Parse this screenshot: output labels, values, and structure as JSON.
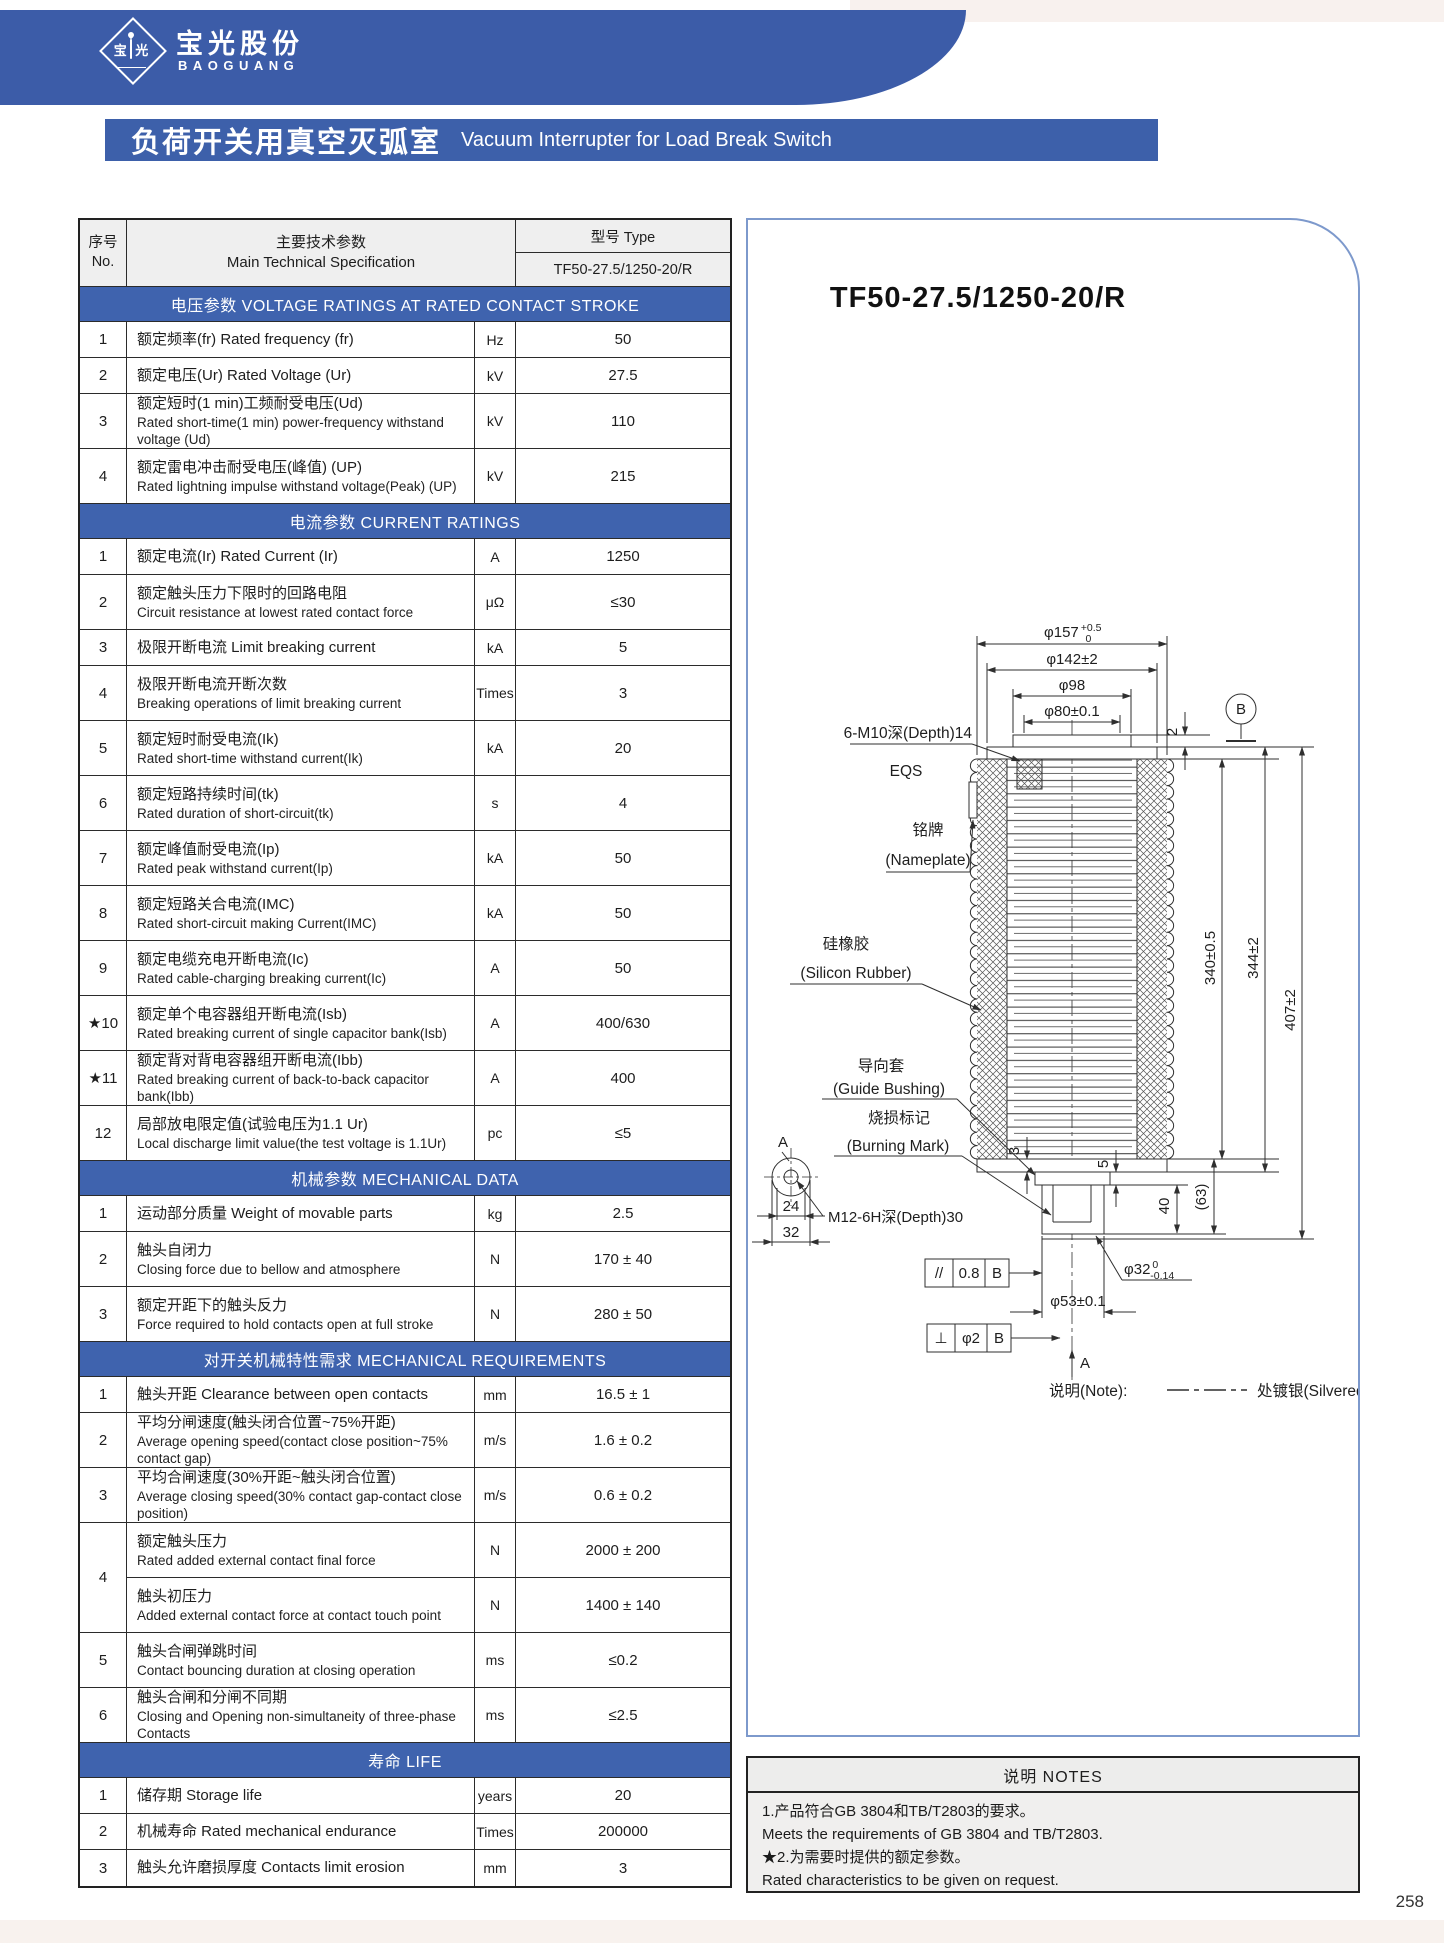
{
  "brand": {
    "logo_left": "宝",
    "logo_right": "光",
    "name_zh": "宝光股份",
    "name_en": "BAOGUANG"
  },
  "page": {
    "title_zh": "负荷开关用真空灭弧室",
    "title_en": "Vacuum Interrupter for Load Break Switch",
    "page_number": "258"
  },
  "table": {
    "header": {
      "no_zh": "序号",
      "no_en": "No.",
      "spec_zh": "主要技术参数",
      "spec_en": "Main Technical Specification",
      "type_label": "型号  Type",
      "type_value": "TF50-27.5/1250-20/R"
    },
    "sections": [
      {
        "title": "电压参数  VOLTAGE RATINGS AT RATED CONTACT STROKE",
        "rows": [
          {
            "no": "1",
            "zh": "额定频率(fr) Rated frequency (fr)",
            "unit": "Hz",
            "value": "50"
          },
          {
            "no": "2",
            "zh": "额定电压(Ur) Rated Voltage (Ur)",
            "unit": "kV",
            "value": "27.5"
          },
          {
            "no": "3",
            "zh": "额定短时(1 min)工频耐受电压(Ud)",
            "en": "Rated short-time(1 min) power-frequency withstand voltage (Ud)",
            "unit": "kV",
            "value": "110"
          },
          {
            "no": "4",
            "zh": "额定雷电冲击耐受电压(峰值) (UP)",
            "en": "Rated lightning impulse withstand voltage(Peak) (UP)",
            "unit": "kV",
            "value": "215"
          }
        ]
      },
      {
        "title": "电流参数  CURRENT RATINGS",
        "rows": [
          {
            "no": "1",
            "zh": "额定电流(Ir) Rated Current (Ir)",
            "unit": "A",
            "value": "1250"
          },
          {
            "no": "2",
            "zh": "额定触头压力下限时的回路电阻",
            "en": "Circuit resistance at lowest rated contact force",
            "unit": "μΩ",
            "value": "≤30"
          },
          {
            "no": "3",
            "zh": "极限开断电流 Limit breaking current",
            "unit": "kA",
            "value": "5"
          },
          {
            "no": "4",
            "zh": "极限开断电流开断次数",
            "en": "Breaking operations of limit breaking current",
            "unit": "Times",
            "value": "3"
          },
          {
            "no": "5",
            "zh": "额定短时耐受电流(Ik)",
            "en": "Rated short-time withstand current(Ik)",
            "unit": "kA",
            "value": "20"
          },
          {
            "no": "6",
            "zh": "额定短路持续时间(tk)",
            "en": "Rated duration of short-circuit(tk)",
            "unit": "s",
            "value": "4"
          },
          {
            "no": "7",
            "zh": "额定峰值耐受电流(Ip)",
            "en": "Rated peak withstand current(Ip)",
            "unit": "kA",
            "value": "50"
          },
          {
            "no": "8",
            "zh": "额定短路关合电流(IMC)",
            "en": "Rated short-circuit making Current(IMC)",
            "unit": "kA",
            "value": "50"
          },
          {
            "no": "9",
            "zh": "额定电缆充电开断电流(Ic)",
            "en": "Rated cable-charging breaking current(Ic)",
            "unit": "A",
            "value": "50"
          },
          {
            "no": "★10",
            "zh": "额定单个电容器组开断电流(Isb)",
            "en": "Rated breaking current of single capacitor bank(Isb)",
            "unit": "A",
            "value": "400/630"
          },
          {
            "no": "★11",
            "zh": "额定背对背电容器组开断电流(Ibb)",
            "en": "Rated breaking current of back-to-back capacitor bank(Ibb)",
            "unit": "A",
            "value": "400"
          },
          {
            "no": "12",
            "zh": "局部放电限定值(试验电压为1.1 Ur)",
            "en": "Local discharge limit value(the test voltage is 1.1Ur)",
            "unit": "pc",
            "value": "≤5"
          }
        ]
      },
      {
        "title": "机械参数  MECHANICAL DATA",
        "rows": [
          {
            "no": "1",
            "zh": "运动部分质量  Weight of movable parts",
            "unit": "kg",
            "value": "2.5"
          },
          {
            "no": "2",
            "zh": "触头自闭力",
            "en": "Closing force due to bellow and atmosphere",
            "unit": "N",
            "value": "170 ± 40"
          },
          {
            "no": "3",
            "zh": "额定开距下的触头反力",
            "en": "Force required to hold contacts open at full stroke",
            "unit": "N",
            "value": "280 ± 50"
          }
        ]
      },
      {
        "title": "对开关机械特性需求  MECHANICAL REQUIREMENTS",
        "rows": [
          {
            "no": "1",
            "zh": "触头开距 Clearance between open contacts",
            "unit": "mm",
            "value": "16.5 ± 1"
          },
          {
            "no": "2",
            "zh": "平均分闸速度(触头闭合位置~75%开距)",
            "en": "Average opening speed(contact close position~75% contact gap)",
            "unit": "m/s",
            "value": "1.6 ± 0.2"
          },
          {
            "no": "3",
            "zh": "平均合闸速度(30%开距~触头闭合位置)",
            "en": "Average closing speed(30% contact gap-contact close position)",
            "unit": "m/s",
            "value": "0.6 ± 0.2"
          },
          {
            "no": "4",
            "sub": [
              {
                "zh": "额定触头压力",
                "en": "Rated added external contact final force",
                "unit": "N",
                "value": "2000 ± 200"
              },
              {
                "zh": "触头初压力",
                "en": "Added external contact force at contact touch point",
                "unit": "N",
                "value": "1400 ± 140"
              }
            ]
          },
          {
            "no": "5",
            "zh": "触头合闸弹跳时间",
            "en": "Contact bouncing duration at closing operation",
            "unit": "ms",
            "value": "≤0.2"
          },
          {
            "no": "6",
            "zh": "触头合闸和分闸不同期",
            "en": "Closing and Opening non-simultaneity of three-phase Contacts",
            "unit": "ms",
            "value": "≤2.5"
          }
        ]
      },
      {
        "title": "寿命  LIFE",
        "rows": [
          {
            "no": "1",
            "zh": "储存期 Storage life",
            "unit": "years",
            "value": "20"
          },
          {
            "no": "2",
            "zh": "机械寿命 Rated mechanical endurance",
            "unit": "Times",
            "value": "200000"
          },
          {
            "no": "3",
            "zh": "触头允许磨损厚度 Contacts limit erosion",
            "unit": "mm",
            "value": "3"
          }
        ]
      }
    ]
  },
  "drawing": {
    "title": "TF50-27.5/1250-20/R",
    "dims": {
      "d157": "φ157",
      "d157_up": "+0.5",
      "d157_dn": "0",
      "d142": "φ142±2",
      "d98": "φ98",
      "d80": "φ80±0.1",
      "dim2": "2",
      "h340": "340±0.5",
      "h344": "344±2",
      "h407": "407±2",
      "dim3": "3",
      "dim5": "5",
      "dim40": "40",
      "dim63": "(63)",
      "d53": "φ53±0.1",
      "d32": "φ32",
      "d32_up": "0",
      "d32_dn": "-0.14",
      "dim24": "24",
      "dim32": "32",
      "bolt": "6-M10深(Depth)14",
      "eqs": "EQS",
      "m12": "M12-6H深(Depth)30",
      "datum_b": "B",
      "sec_a": "A",
      "arrow_a": "A"
    },
    "labels": {
      "nameplate_zh": "铭牌",
      "nameplate_en": "(Nameplate)",
      "rubber_zh": "硅橡胶",
      "rubber_en": "(Silicon Rubber)",
      "bushing_zh": "导向套",
      "bushing_en": "(Guide Bushing)",
      "burn_zh": "烧损标记",
      "burn_en": "(Burning Mark)"
    },
    "fcf1": {
      "sym": "//",
      "tol": "0.8",
      "datum": "B"
    },
    "fcf2": {
      "sym": "⊥",
      "tol": "φ2",
      "datum": "B"
    },
    "note": {
      "label": "说明(Note):",
      "text": "处镀银(Silvered)"
    }
  },
  "notes": {
    "title": "说明  NOTES",
    "lines": [
      "1.产品符合GB 3804和TB/T2803的要求。",
      "Meets the requirements of GB 3804 and TB/T2803.",
      "★2.为需要时提供的额定参数。",
      " Rated characteristics to be given on request."
    ]
  }
}
